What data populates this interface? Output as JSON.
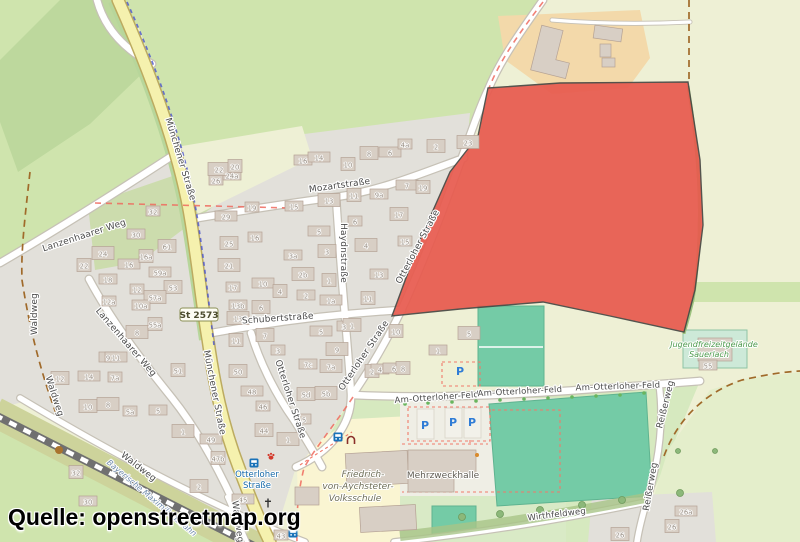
{
  "attribution": "Quelle: openstreetmap.org",
  "road_ref": "St 2573",
  "colors": {
    "highlight_red": "#e85a4e",
    "road_yellow": "#f5f1ae",
    "pitch_teal": "#74cba6",
    "grass_green": "#cfe4ad",
    "residential_gray": "#e2e0da",
    "school_yellow": "#faf5d2",
    "farmyard_orange": "#f3d9aa",
    "transit_blue": "#1569a8",
    "parking_blue": "#2f7cd6",
    "boundary_red": "#ef6a5e",
    "track_brown": "#a06a2a",
    "cycle_blue": "#4a54cc"
  },
  "street_labels": [
    {
      "t": "Münchener Straße",
      "x": 178,
      "y": 160,
      "r": 73
    },
    {
      "t": "Münchener Straße",
      "x": 212,
      "y": 393,
      "r": 79
    },
    {
      "t": "Mozartstraße",
      "x": 340,
      "y": 188,
      "r": -8
    },
    {
      "t": "Haydnstraße",
      "x": 341,
      "y": 253,
      "r": 90
    },
    {
      "t": "Schubertstraße",
      "x": 278,
      "y": 321,
      "r": -4
    },
    {
      "t": "Otterloher Straße",
      "x": 420,
      "y": 248,
      "r": -62
    },
    {
      "t": "Otterloher Straße",
      "x": 366,
      "y": 357,
      "r": -56
    },
    {
      "t": "Otterloher Straße",
      "x": 288,
      "y": 400,
      "r": 72
    },
    {
      "t": "Lanzenhaarer Weg",
      "x": 85,
      "y": 238,
      "r": -18
    },
    {
      "t": "Lanzenhaarer Weg",
      "x": 124,
      "y": 344,
      "r": 49
    },
    {
      "t": "Waldweg",
      "x": 37,
      "y": 314,
      "r": -90
    },
    {
      "t": "Waldweg",
      "x": 52,
      "y": 397,
      "r": 72
    },
    {
      "t": "Waldweg",
      "x": 137,
      "y": 469,
      "r": 38
    },
    {
      "t": "Waldweg",
      "x": 235,
      "y": 522,
      "r": 82
    },
    {
      "t": "Am-Otterloher-Feld",
      "x": 437,
      "y": 400,
      "r": -4,
      "s": "small"
    },
    {
      "t": "Am-Otterloher-Feld",
      "x": 520,
      "y": 394,
      "r": -3,
      "s": "small"
    },
    {
      "t": "Am-Otterloher-Feld",
      "x": 618,
      "y": 389,
      "r": -2,
      "s": "small"
    },
    {
      "t": "Reißerweg",
      "x": 668,
      "y": 405,
      "r": -76
    },
    {
      "t": "Reißerweg",
      "x": 653,
      "y": 487,
      "r": -80
    },
    {
      "t": "Wirthfeldweg",
      "x": 557,
      "y": 517,
      "r": -7,
      "s": "small"
    }
  ],
  "house_numbers": [
    [
      "32",
      153,
      213
    ],
    [
      "30",
      136,
      236
    ],
    [
      "24",
      103,
      255
    ],
    [
      "22",
      84,
      267
    ],
    [
      "18",
      108,
      281
    ],
    [
      "16",
      129,
      266
    ],
    [
      "16a",
      146,
      258
    ],
    [
      "61",
      167,
      248
    ],
    [
      "59a",
      160,
      274
    ],
    [
      "12",
      137,
      291
    ],
    [
      "53",
      173,
      289
    ],
    [
      "57a",
      155,
      299
    ],
    [
      "12a",
      109,
      303
    ],
    [
      "10a",
      141,
      307
    ],
    [
      "8",
      137,
      334
    ],
    [
      "55a",
      155,
      326
    ],
    [
      "9",
      108,
      359
    ],
    [
      "11",
      116,
      359
    ],
    [
      "51",
      178,
      372
    ],
    [
      "12",
      60,
      380
    ],
    [
      "14",
      89,
      378
    ],
    [
      "7a",
      115,
      379
    ],
    [
      "10",
      88,
      408
    ],
    [
      "8",
      108,
      406
    ],
    [
      "5a",
      130,
      413
    ],
    [
      "5",
      158,
      412
    ],
    [
      "1",
      183,
      433
    ],
    [
      "32",
      76,
      474
    ],
    [
      "30",
      88,
      503
    ],
    [
      "49",
      211,
      441
    ],
    [
      "47b",
      218,
      460
    ],
    [
      "2",
      199,
      488
    ],
    [
      "45",
      243,
      501
    ],
    [
      "43",
      281,
      537
    ],
    [
      "44",
      264,
      432
    ],
    [
      "1",
      288,
      441
    ],
    [
      "26",
      216,
      182
    ],
    [
      "24a",
      232,
      177
    ],
    [
      "22",
      219,
      171
    ],
    [
      "20",
      235,
      168
    ],
    [
      "16",
      303,
      162
    ],
    [
      "14",
      319,
      159
    ],
    [
      "10",
      348,
      166
    ],
    [
      "8",
      369,
      155
    ],
    [
      "6",
      390,
      154
    ],
    [
      "4a",
      405,
      146
    ],
    [
      "2",
      436,
      148
    ],
    [
      "23",
      468,
      144
    ],
    [
      "19",
      252,
      209
    ],
    [
      "15",
      294,
      208
    ],
    [
      "13",
      329,
      202
    ],
    [
      "11",
      354,
      197
    ],
    [
      "9a",
      379,
      196
    ],
    [
      "7",
      407,
      187
    ],
    [
      "19",
      423,
      189
    ],
    [
      "17",
      399,
      216
    ],
    [
      "29",
      226,
      218
    ],
    [
      "16",
      255,
      239
    ],
    [
      "25",
      229,
      245
    ],
    [
      "21",
      229,
      267
    ],
    [
      "17",
      233,
      289
    ],
    [
      "13b",
      238,
      307
    ],
    [
      "13",
      238,
      320
    ],
    [
      "11",
      236,
      342
    ],
    [
      "3a",
      293,
      257
    ],
    [
      "10",
      263,
      285
    ],
    [
      "4",
      280,
      293
    ],
    [
      "6",
      261,
      309
    ],
    [
      "5",
      319,
      233
    ],
    [
      "6",
      355,
      223
    ],
    [
      "3",
      327,
      253
    ],
    [
      "4",
      366,
      247
    ],
    [
      "15",
      405,
      243
    ],
    [
      "13",
      379,
      276
    ],
    [
      "2b",
      303,
      276
    ],
    [
      "1",
      329,
      282
    ],
    [
      "2",
      306,
      297
    ],
    [
      "1a",
      331,
      302
    ],
    [
      "11",
      368,
      300
    ],
    [
      "7",
      265,
      337
    ],
    [
      "5",
      321,
      333
    ],
    [
      "3",
      344,
      328
    ],
    [
      "1",
      352,
      327
    ],
    [
      "9",
      337,
      351
    ],
    [
      "3",
      278,
      352
    ],
    [
      "7c",
      308,
      366
    ],
    [
      "7a",
      331,
      368
    ],
    [
      "2",
      372,
      373
    ],
    [
      "4",
      380,
      371
    ],
    [
      "6",
      394,
      370
    ],
    [
      "8",
      403,
      370
    ],
    [
      "50",
      238,
      373
    ],
    [
      "48",
      252,
      393
    ],
    [
      "46",
      263,
      408
    ],
    [
      "5d",
      306,
      396
    ],
    [
      "5b",
      326,
      395
    ],
    [
      "5",
      304,
      421
    ],
    [
      "1",
      438,
      352
    ],
    [
      "5",
      469,
      335
    ],
    [
      "10",
      396,
      333
    ],
    [
      "55",
      708,
      367
    ],
    [
      "26a",
      686,
      513
    ],
    [
      "26",
      672,
      528
    ],
    [
      "26",
      620,
      536
    ]
  ],
  "poi_labels": [
    {
      "t": "Mehrzweckhalle",
      "x": 443,
      "y": 478,
      "fs": 9,
      "c": "#5f5b52",
      "i": false,
      "r": 0
    },
    {
      "t": "Friedrich-",
      "x": 363,
      "y": 477,
      "fs": 9,
      "c": "#6e6e57",
      "i": true,
      "r": 0
    },
    {
      "t": "von-Aychsteter-",
      "x": 358,
      "y": 489,
      "fs": 9,
      "c": "#6e6e57",
      "i": true,
      "r": 0
    },
    {
      "t": "Volksschule",
      "x": 355,
      "y": 501,
      "fs": 9,
      "c": "#6e6e57",
      "i": true,
      "r": 0
    },
    {
      "t": "Jugendfreizeitgelände",
      "x": 714,
      "y": 347,
      "fs": 8,
      "c": "#4c9a4c",
      "i": true,
      "r": 0
    },
    {
      "t": "Sauerlach",
      "x": 709,
      "y": 357,
      "fs": 8,
      "c": "#4c9a4c",
      "i": true,
      "r": 0
    },
    {
      "t": "Bayerische Maximiliansbahn",
      "x": 150,
      "y": 500,
      "fs": 8,
      "c": "#708bab",
      "i": true,
      "r": 40
    },
    {
      "t": "Otterloher",
      "x": 257,
      "y": 477,
      "fs": 8.5,
      "c": "#1569a8",
      "i": false,
      "r": 0
    },
    {
      "t": "Straße",
      "x": 257,
      "y": 488,
      "fs": 8.5,
      "c": "#1569a8",
      "i": false,
      "r": 0
    }
  ],
  "icons": [
    {
      "type": "parking",
      "x": 460,
      "y": 371
    },
    {
      "type": "parking",
      "x": 425,
      "y": 425
    },
    {
      "type": "parking",
      "x": 453,
      "y": 422
    },
    {
      "type": "parking",
      "x": 472,
      "y": 422
    },
    {
      "type": "bus-stop",
      "x": 254,
      "y": 463
    },
    {
      "type": "bus-stop",
      "x": 338,
      "y": 437
    },
    {
      "type": "bus-stop",
      "x": 293,
      "y": 533
    },
    {
      "type": "veterinary",
      "x": 271,
      "y": 456
    },
    {
      "type": "memorial",
      "x": 268,
      "y": 503
    },
    {
      "type": "traffic-signal",
      "x": 291,
      "y": 523
    },
    {
      "type": "gate",
      "x": 351,
      "y": 441
    },
    {
      "type": "poi-dot",
      "x": 59,
      "y": 450
    }
  ]
}
